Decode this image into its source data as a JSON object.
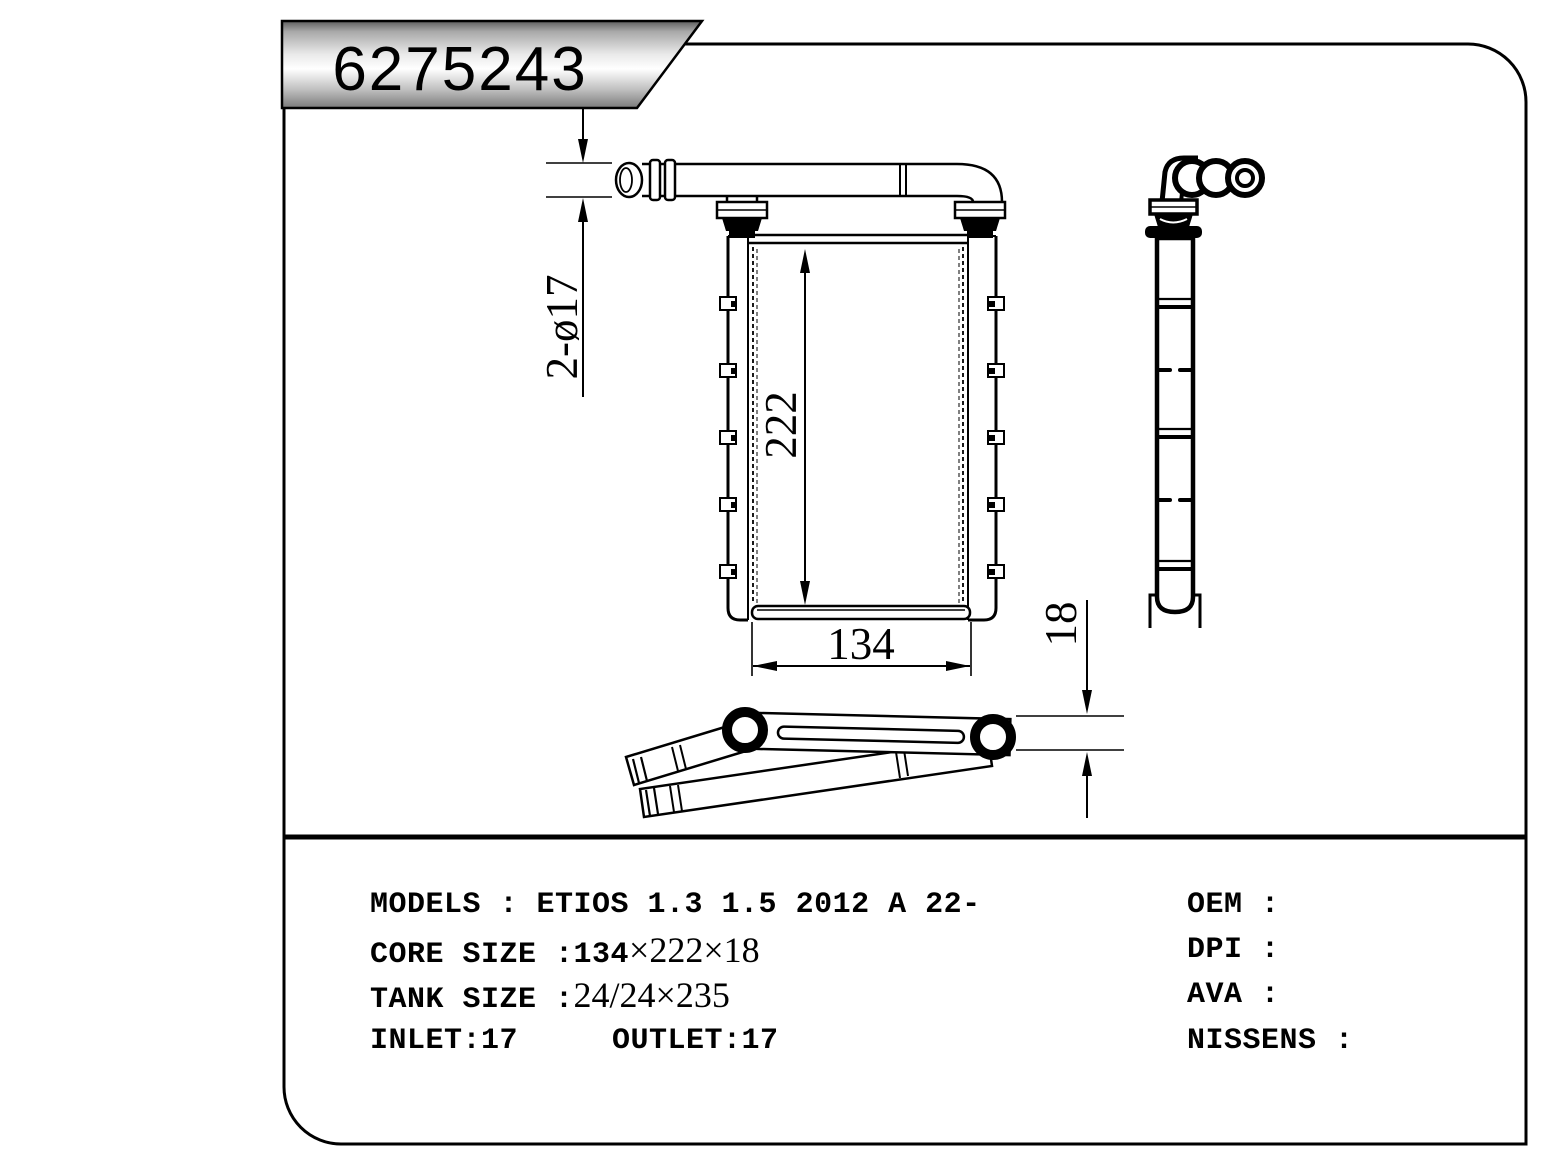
{
  "banner": {
    "part_number": "6275243"
  },
  "annotations": {
    "ports": "2-ø17",
    "height": "222",
    "width": "134",
    "depth": "18"
  },
  "specs": {
    "models_label": "MODELS : ETIOS 1.3 1.5 2012 A 22-",
    "core_label": "CORE SIZE :134",
    "core_value": "×222×18",
    "tank_label": "TANK SIZE :",
    "tank_value": "24/24×235",
    "inlet": "INLET:17",
    "outlet": "OUTLET:17",
    "oem": "OEM :",
    "dpi": "DPI :",
    "ava": "AVA :",
    "nissens": "NISSENS :"
  },
  "colors": {
    "line": "#000000",
    "background": "#ffffff",
    "banner_dark": "#5f5f5f",
    "banner_mid": "#e9e9e9",
    "banner_light": "#ffffff",
    "banner_bottom": "#7a7a7a"
  }
}
